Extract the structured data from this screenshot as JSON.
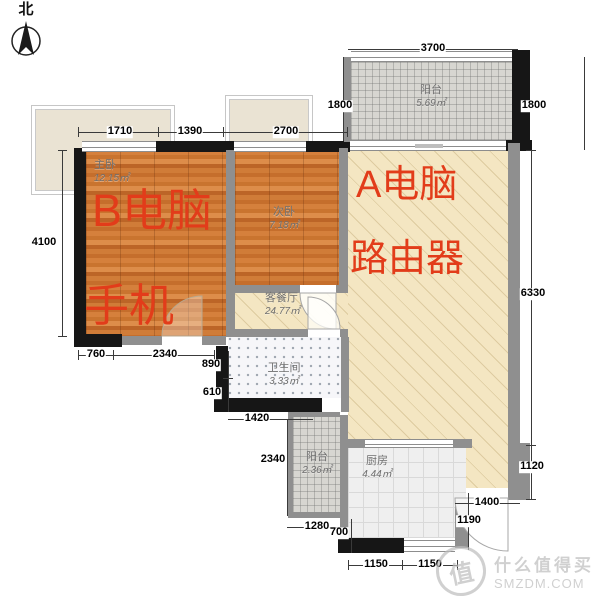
{
  "compass": {
    "label": "北"
  },
  "rooms": [
    {
      "id": "master-bedroom",
      "name": "主卧",
      "area": "12.15㎡"
    },
    {
      "id": "second-bedroom",
      "name": "次卧",
      "area": "7.18㎡"
    },
    {
      "id": "living-dining",
      "name": "客餐厅",
      "area": "24.77㎡"
    },
    {
      "id": "bathroom",
      "name": "卫生间",
      "area": "3.33㎡"
    },
    {
      "id": "balcony-top",
      "name": "阳台",
      "area": "5.69㎡"
    },
    {
      "id": "balcony-bottom",
      "name": "阳台",
      "area": "2.36㎡"
    },
    {
      "id": "kitchen",
      "name": "厨房",
      "area": "4.44㎡"
    }
  ],
  "annotations": [
    {
      "id": "a-computer",
      "text": "A电脑"
    },
    {
      "id": "router",
      "text": "路由器"
    },
    {
      "id": "b-computer",
      "text": "B电脑"
    },
    {
      "id": "phone",
      "text": "手机"
    }
  ],
  "dims": [
    {
      "id": "top-balcony-width",
      "v": "3700"
    },
    {
      "id": "balcony-left-height",
      "v": "1800"
    },
    {
      "id": "balcony-right-height",
      "v": "1800"
    },
    {
      "id": "top-seg-1",
      "v": "1710"
    },
    {
      "id": "top-seg-2",
      "v": "1390"
    },
    {
      "id": "top-seg-3",
      "v": "2700"
    },
    {
      "id": "left-height",
      "v": "4100"
    },
    {
      "id": "bottom-left-seg-1",
      "v": "760"
    },
    {
      "id": "bottom-left-seg-2",
      "v": "2340"
    },
    {
      "id": "mid-vert-1",
      "v": "890"
    },
    {
      "id": "mid-vert-2",
      "v": "610"
    },
    {
      "id": "mid-horiz",
      "v": "1420"
    },
    {
      "id": "balcony2-height",
      "v": "2340"
    },
    {
      "id": "bottom-horiz-1280",
      "v": "1280"
    },
    {
      "id": "bottom-vert-700",
      "v": "700"
    },
    {
      "id": "bottom-1150-a",
      "v": "1150"
    },
    {
      "id": "bottom-1150-b",
      "v": "1150"
    },
    {
      "id": "right-1190",
      "v": "1190"
    },
    {
      "id": "right-1400",
      "v": "1400"
    },
    {
      "id": "right-1120",
      "v": "1120"
    },
    {
      "id": "right-6330",
      "v": "6330"
    }
  ],
  "watermark": {
    "logo": "值",
    "name": "什么值得买",
    "site": "SMZDM.COM"
  },
  "colors": {
    "annotation_red": "#e23c1a",
    "wall_black": "#161616",
    "wall_grey": "#8f8f8f",
    "wood_floor": "#d07c38",
    "living_beige": "#f4e6c2"
  }
}
